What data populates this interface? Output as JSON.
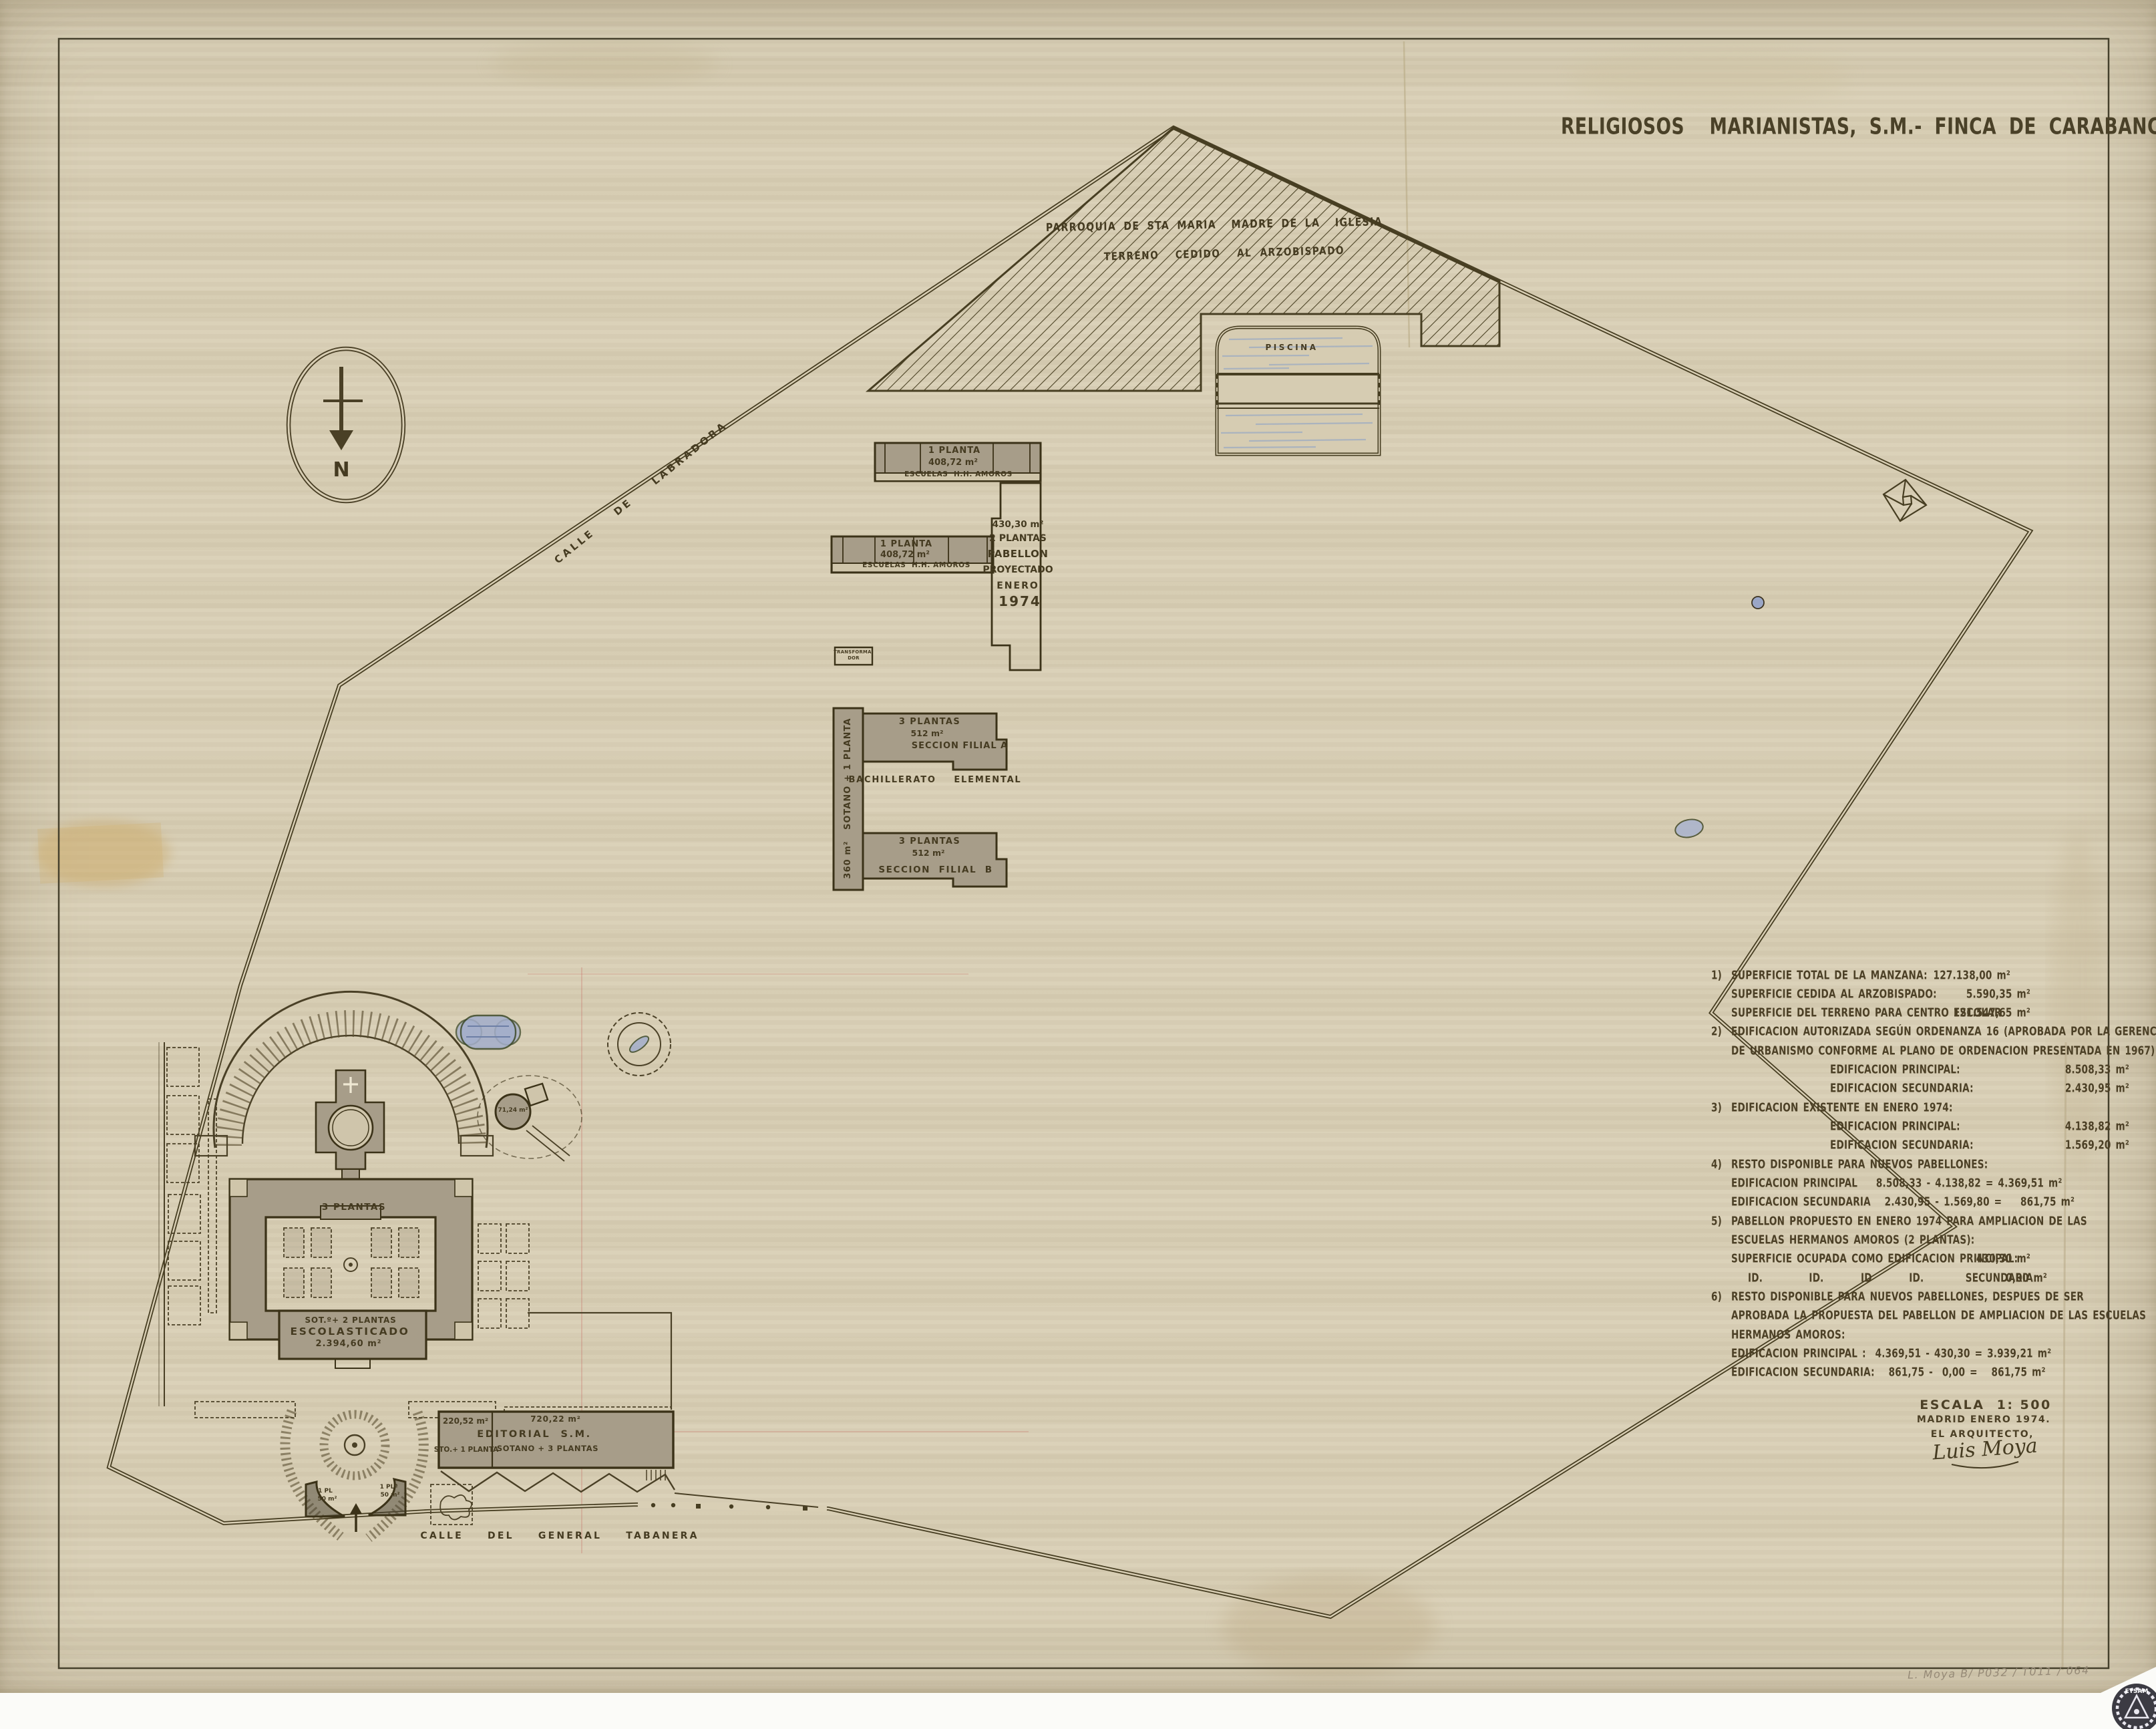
{
  "title": "RELIGIOSOS  MARIANISTAS, S.M.- FINCA DE CARABANCHEL",
  "compass": {
    "label": "N"
  },
  "streets": {
    "labradora": "CALLE  DE  LABRADORA",
    "tabanera": "CALLE  DEL  GENERAL  TABANERA"
  },
  "parroquia": {
    "line1": "PARROQUIA DE STA MARIA  MADRE DE LA  IGLESIA",
    "line2": "TERRENO  CEDIDO  AL ARZOBISPADO"
  },
  "piscina": {
    "label": "PISCINA"
  },
  "escuelas_a": {
    "plantas": "1 PLANTA",
    "area": "408,72 m²",
    "name": "ESCUELAS  H.H. AMOROS"
  },
  "escuelas_b": {
    "plantas": "1 PLANTA",
    "area": "408,72 m²",
    "name": "ESCUELAS  H.H. AMOROS"
  },
  "pabellon": {
    "area": "430,30 m²",
    "plantas": "2 PLANTAS",
    "l3": "PABELLON",
    "l4": "PROYECTADO",
    "l5": "ENERO",
    "l6": "1974"
  },
  "transformador": {
    "line1": "TRANSFORMA-",
    "line2": "DOR"
  },
  "filial": {
    "wing": "360 m²   SOTANO + 1 PLANTA",
    "a_plantas": "3 PLANTAS",
    "a_area": "512 m²",
    "a_name": "SECCION FILIAL A",
    "middle": "BACHILLERATO  ELEMENTAL",
    "b_plantas": "3 PLANTAS",
    "b_area": "512 m²",
    "b_name": "SECCION  FILIAL  B"
  },
  "escolasticado": {
    "plantas": "3 PLANTAS",
    "floors": "SOT.º+ 2 PLANTAS",
    "name": "ESCOLASTICADO",
    "area": "2.394,60 m²"
  },
  "tower": {
    "area": "71,24 m²"
  },
  "editorial": {
    "left_area": "220,52 m²",
    "left_floors": "STO.+ 1 PLANTA",
    "right_area": "720,22 m²",
    "name": "EDITORIAL  S.M.",
    "right_floors": "SOTANO + 3 PLANTAS"
  },
  "gates": {
    "left_l1": "1 PL",
    "left_l2": "50 m²",
    "right_l1": "1 PLª",
    "right_l2": "50 m²"
  },
  "legend": {
    "lines": [
      {
        "num": "1)",
        "text": "SUPERFICIE TOTAL DE LA MANZANA:",
        "value": "127.138,00 m²"
      },
      {
        "text": "SUPERFICIE CEDIDA AL ARZOBISPADO:",
        "value": "5.590,35 m²"
      },
      {
        "text": "SUPERFICIE DEL TERRENO PARA CENTRO ESCOLAR",
        "value": "121.547,65 m²"
      },
      {
        "num": "2)",
        "text": "EDIFICACION AUTORIZADA SEGÚN ORDENANZA 16 (APROBADA POR LA GERENCIA"
      },
      {
        "text": "DE URBANISMO CONFORME AL PLANO DE ORDENACION PRESENTADA EN 1967)"
      },
      {
        "text": "EDIFICACION PRINCIPAL:",
        "value": "8.508,33 m²"
      },
      {
        "text": "EDIFICACION SECUNDARIA:",
        "value": "2.430,95 m²"
      },
      {
        "num": "3)",
        "text": "EDIFICACION EXISTENTE EN ENERO 1974:"
      },
      {
        "text": "EDIFICACION PRINCIPAL:",
        "value": "4.138,82 m²"
      },
      {
        "text": "EDIFICACION SECUNDARIA:",
        "value": "1.569,20 m²"
      },
      {
        "num": "4)",
        "text": "RESTO DISPONIBLE PARA NUEVOS PABELLONES:"
      },
      {
        "text": "EDIFICACION PRINCIPAL    8.508,33 - 4.138,82 = 4.369,51 m²"
      },
      {
        "text": "EDIFICACION SECUNDARIA   2.430,95 - 1.569,80 =    861,75 m²"
      },
      {
        "num": "5)",
        "text": "PABELLON PROPUESTO EN ENERO 1974 PARA AMPLIACION DE LAS"
      },
      {
        "text": "ESCUELAS HERMANOS AMOROS (2 PLANTAS):"
      },
      {
        "text": "SUPERFICIE OCUPADA COMO EDIFICACION PRINCIPAL:",
        "value": "430,30 m²"
      },
      {
        "text": "ID.          ID.        ID        ID.         SECUNDARIA:",
        "value": "0,00 m²"
      },
      {
        "num": "6)",
        "text": "RESTO DISPONIBLE PARA NUEVOS PABELLONES, DESPUES DE SER"
      },
      {
        "text": "APROBADA LA PROPUESTA DEL PABELLON DE AMPLIACION DE LAS ESCUELAS"
      },
      {
        "text": "HERMANOS AMOROS:"
      },
      {
        "text": "EDIFICACION PRINCIPAL :  4.369,51 - 430,30 = 3.939,21 m²"
      },
      {
        "text": "EDIFICACION SECUNDARIA:   861,75 -  0,00 =   861,75 m²"
      }
    ]
  },
  "scale_block": {
    "scale": "ESCALA  1: 500",
    "place": "MADRID ENERO 1974.",
    "role": "EL ARQUITECTO,",
    "signature": "Luis Moya"
  },
  "pencil_note": "L. Moya B/ P032 / T011 / 064",
  "stamp": {
    "text": "ETSAM"
  },
  "colors": {
    "ink": "#453b21",
    "paper": "#d9cfb5",
    "building_gray": "#a79d89",
    "water_blue": "#8ea3c7"
  }
}
